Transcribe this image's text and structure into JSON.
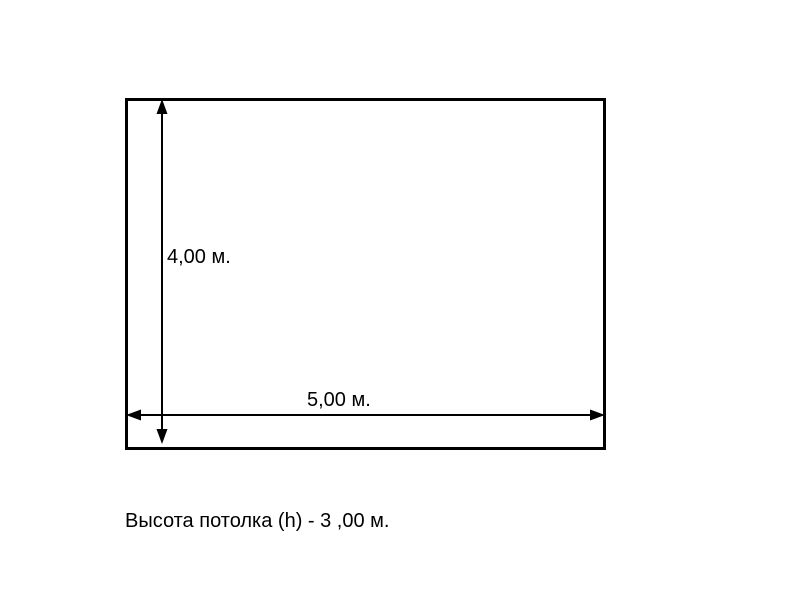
{
  "diagram": {
    "type": "room-dimension-sketch",
    "height_label": "4,00 м.",
    "width_label": "5,00 м.",
    "caption": "Высота потолка (h) - 3 ,00 м.",
    "height_value_m": 4.0,
    "width_value_m": 5.0,
    "ceiling_height_value_m": 3.0
  },
  "colors": {
    "background": "#ffffff",
    "line": "#000000",
    "text": "#000000"
  }
}
